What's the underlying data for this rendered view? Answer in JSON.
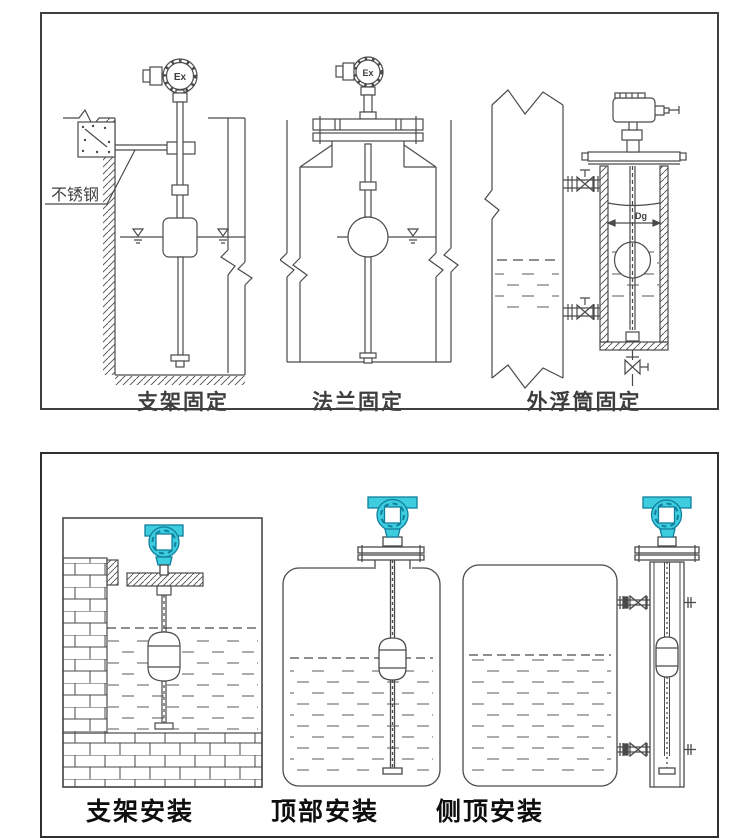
{
  "colors": {
    "line": "#4a4a4a",
    "panel_border": "#3f3f3f",
    "transmitter_teal": "#3ecddf",
    "transmitter_teal_dark": "#0f7f9e",
    "caption_top": "#3e3e3e",
    "caption_bottom": "#0e0e0e"
  },
  "top_panel": {
    "figures": [
      {
        "caption": "支架固定",
        "head_label": "Ex",
        "material_label": "不锈钢"
      },
      {
        "caption": "法兰固定",
        "head_label": "Ex"
      },
      {
        "caption": "外浮筒固定",
        "diameter_label": "Dg"
      }
    ]
  },
  "bottom_panel": {
    "figures": [
      {
        "caption": "支架安装"
      },
      {
        "caption": "顶部安装"
      },
      {
        "caption": "侧顶安装"
      }
    ]
  }
}
